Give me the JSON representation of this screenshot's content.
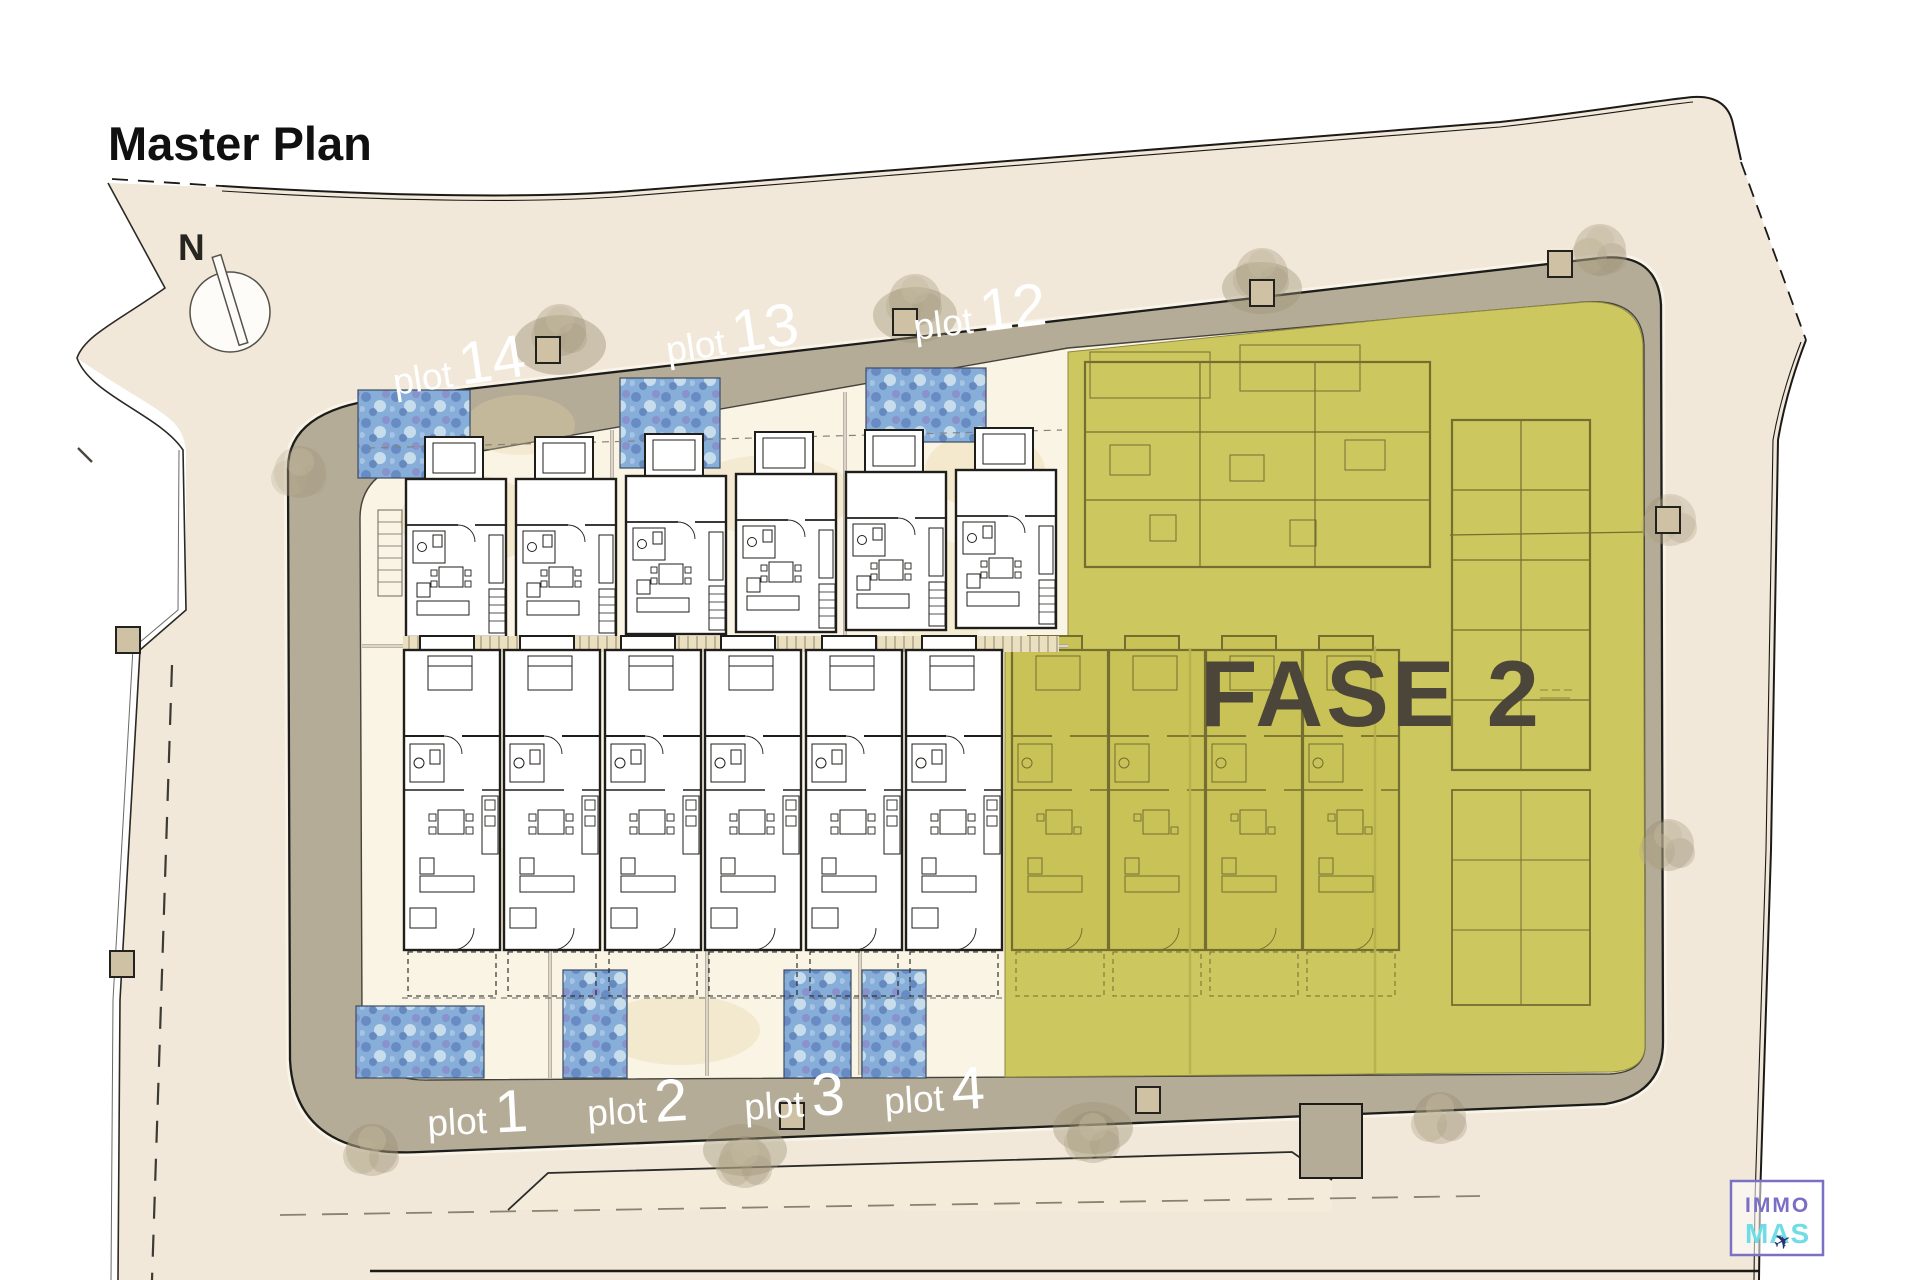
{
  "title": "Master Plan",
  "compass": {
    "label": "N"
  },
  "phase": {
    "label": "FASE 2"
  },
  "plots": {
    "top": [
      {
        "word": "plot",
        "num": "14"
      },
      {
        "word": "plot",
        "num": "13"
      },
      {
        "word": "plot",
        "num": "12"
      }
    ],
    "bottom": [
      {
        "word": "plot",
        "num": "1"
      },
      {
        "word": "plot",
        "num": "2"
      },
      {
        "word": "plot",
        "num": "3"
      },
      {
        "word": "plot",
        "num": "4"
      }
    ]
  },
  "logo": {
    "line1": "IMMO",
    "line2": "MAS",
    "plane_icon": "✈"
  },
  "colors": {
    "land_beige": "#f1e8d9",
    "road_grey": "#b5ac97",
    "plots_cream": "#faf4e4",
    "phase_olive": "#cdc75f",
    "pool_blue": "#86aed8",
    "wall_dark": "#1f1e1b",
    "phase_line_olive": "#756e31",
    "logo_purple": "#7b6fc5",
    "logo_cyan": "#6edde6",
    "phase_text": "#4b4639"
  }
}
